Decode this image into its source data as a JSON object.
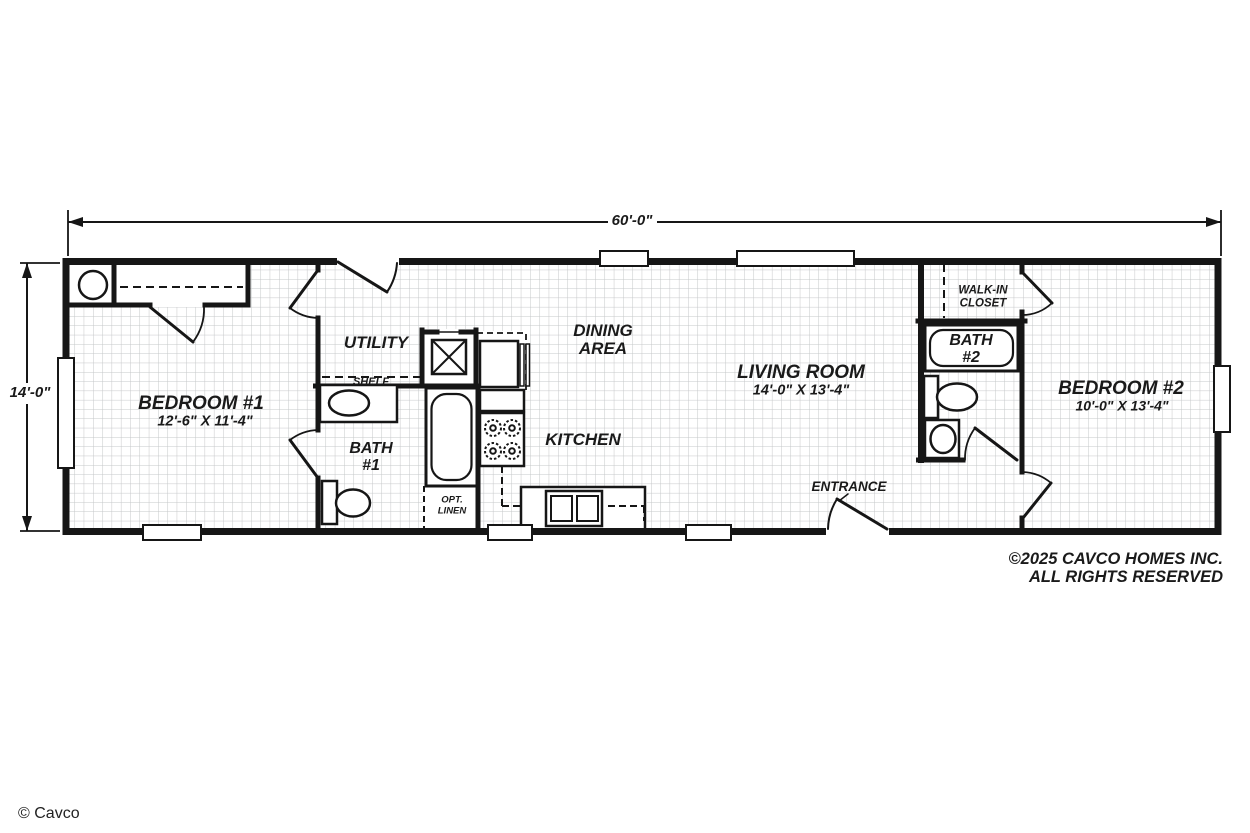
{
  "title": "Single-wide manufactured home floor plan",
  "dimensions": {
    "overall_width": "60'-0\"",
    "overall_depth": "14'-0\""
  },
  "rooms": {
    "bedroom1": {
      "name": "BEDROOM #1",
      "size": "12'-6\" X 11'-4\""
    },
    "bath1": {
      "line1": "BATH",
      "line2": "#1"
    },
    "utility": {
      "name": "UTILITY",
      "shelf_label": "SHELF"
    },
    "opt_linen": {
      "line1": "OPT.",
      "line2": "LINEN"
    },
    "kitchen": {
      "name": "KITCHEN"
    },
    "dining": {
      "line1": "DINING",
      "line2": "AREA"
    },
    "living": {
      "name": "LIVING ROOM",
      "size": "14'-0\" X 13'-4\""
    },
    "entrance": {
      "name": "ENTRANCE"
    },
    "walk_in_closet": {
      "line1": "WALK-IN",
      "line2": "CLOSET"
    },
    "bath2": {
      "line1": "BATH",
      "line2": "#2"
    },
    "bedroom2": {
      "name": "BEDROOM #2",
      "size": "10'-0\" X 13'-4\""
    }
  },
  "footer": {
    "copyright_line1": "©2025 CAVCO HOMES INC.",
    "copyright_line2": "ALL RIGHTS RESERVED",
    "credit": "© Cavco"
  },
  "colors": {
    "wall": "#161616",
    "grid_line": "#c5c7c9",
    "background": "#ffffff",
    "text": "#1a1a1a"
  }
}
